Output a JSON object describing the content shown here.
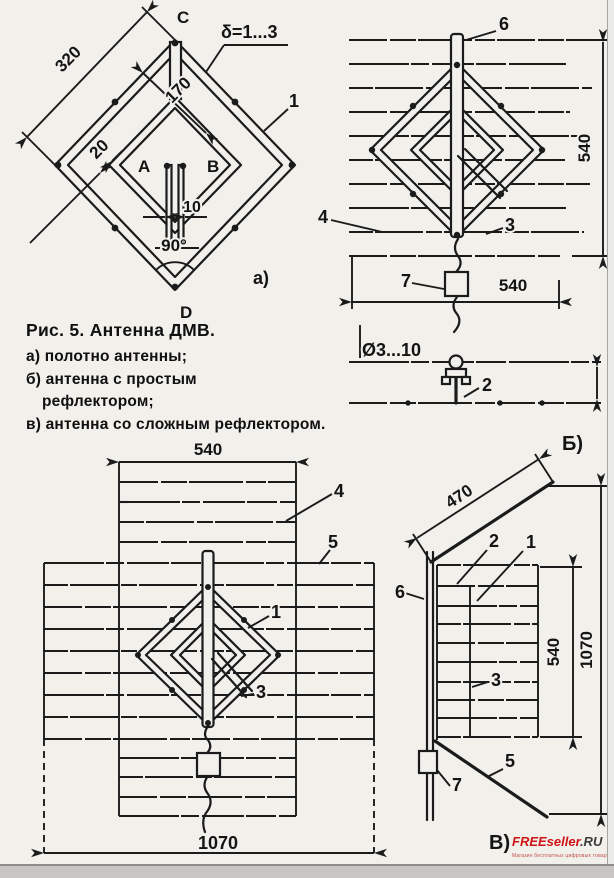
{
  "canvas": {
    "paper": "#f2f0eb",
    "ink": "#1b1b1b"
  },
  "caption": {
    "title": "Рис. 5. Антенна ДМВ.",
    "line_a": "а) полотно антенны;",
    "line_b1": "б) антенна с простым",
    "line_b2": "рефлектором;",
    "line_v": "в) антенна со сложным рефлектором."
  },
  "diagram_a": {
    "caption": "а)",
    "point_top": "C",
    "point_bottom": "D",
    "point_left": "A",
    "point_right": "B",
    "part_frame": "1",
    "thickness_note": "δ=1...3",
    "dim_outer": "320",
    "dim_inner": "170",
    "dim_strip": "20",
    "dim_gap": "10",
    "dim_angle": "90°"
  },
  "diagram_b": {
    "caption": "Б)",
    "part_mast": "6",
    "part_reflector": "4",
    "part_feeder": "3",
    "part_matcher": "7",
    "part_stand": "2",
    "dim_height": "540",
    "dim_width": "540",
    "dim_rods": "Ø3...10"
  },
  "diagram_v_front": {
    "part_reflector": "4",
    "part_side": "5",
    "part_panel": "1",
    "part_feeder": "3",
    "dim_top": "540",
    "dim_bottom": "1070"
  },
  "diagram_v_side": {
    "caption": "В)",
    "part_mast": "6",
    "part_stand": "2",
    "part_panel": "1",
    "part_feeder": "3",
    "part_flap": "5",
    "part_matcher": "7",
    "dim_flap": "470",
    "dim_center": "540",
    "dim_total": "1070"
  },
  "logo": {
    "brand": "FREEseller",
    "tld": ".RU",
    "tagline": "Магазин бесплатных цифровых товаров"
  }
}
